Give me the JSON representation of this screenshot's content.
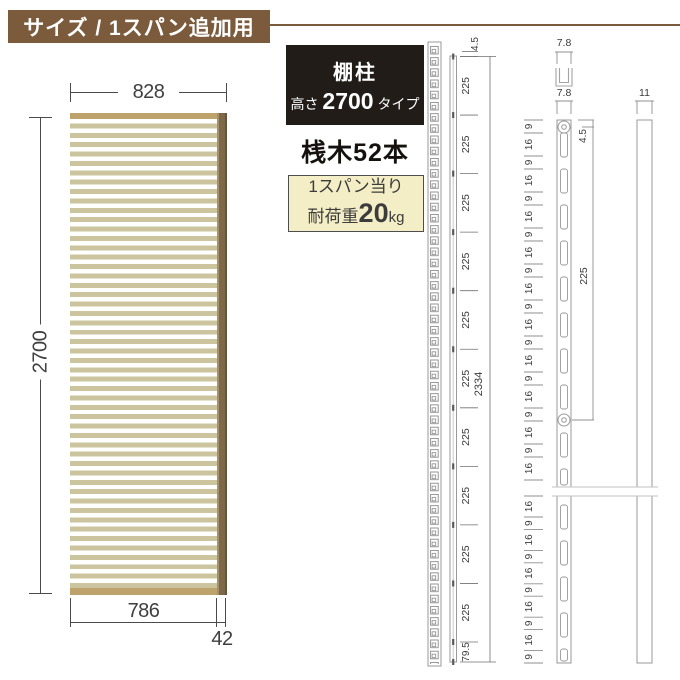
{
  "header": {
    "title": "サイズ / 1スパン追加用"
  },
  "product_badge": {
    "name": "棚柱",
    "height_prefix": "高さ",
    "height_value": "2700",
    "height_suffix": "タイプ"
  },
  "slat_count_label": "桟木52本",
  "load_box": {
    "line1": "1スパン当り",
    "prefix": "耐荷重",
    "value": "20",
    "unit": "kg"
  },
  "panel_diagram": {
    "width_top": "828",
    "height": "2700",
    "width_bottom": "786",
    "post_width": "42"
  },
  "rail_drawing": {
    "top_offset": "4.5",
    "segment_label": "225",
    "segment_count": 10,
    "bottom_offset": "79.5",
    "total": "2334"
  },
  "post_drawing": {
    "cap_width": "7.8",
    "front_width": "7.8",
    "side_width": "11",
    "hole_offset": "4.5",
    "hole_pitch": "225",
    "slot_pattern_upper": [
      "9",
      "16",
      "9",
      "16",
      "9",
      "16",
      "9",
      "16",
      "9",
      "16",
      "9",
      "16",
      "9",
      "16",
      "9",
      "16",
      "9",
      "16",
      "9",
      "16"
    ],
    "slot_pattern_lower": [
      "16",
      "9",
      "16",
      "9",
      "16",
      "9",
      "16",
      "9",
      "16",
      "9"
    ]
  },
  "colors": {
    "accent_brown": "#7b5b3c",
    "badge_bg": "#211c17",
    "load_box_bg": "#f3eec6",
    "slat": "#cbc49e",
    "cap": "#bda26c",
    "post": "#7d684a"
  }
}
